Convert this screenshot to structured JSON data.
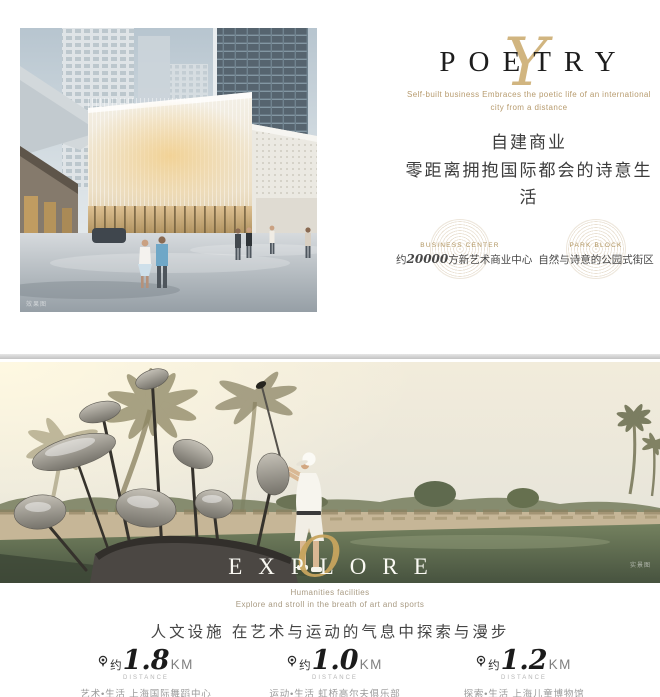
{
  "colors": {
    "gold_accent": "#c9a96b",
    "dark_text": "#1d1d1d",
    "chinese_text": "#3c3c3c",
    "grey_text": "#9b9b9b"
  },
  "poetry": {
    "script": "Y",
    "title": "POETRY",
    "sub1": "Self-built business Embraces the poetic life of an international",
    "sub2": "city from a distance",
    "zh1": "自建商业",
    "zh2": "零距离拥抱国际都会的诗意生活",
    "badges": [
      {
        "en": "BUSINESS CENTER",
        "zh_pre": "约",
        "zh_num": "20000",
        "zh_post": "方新艺术商业中心"
      },
      {
        "en": "PARK BLOCK",
        "zh": "自然与诗意的公园式街区"
      }
    ],
    "watermark": "效果图"
  },
  "explore": {
    "script": "O",
    "title": "EXPLORE",
    "sub1": "Humanities facilities",
    "sub2": "Explore and stroll in the breath of art and sports",
    "heading": "人文设施 在艺术与运动的气息中探索与漫步",
    "watermark": "实景图",
    "distances": [
      {
        "prefix": "约",
        "value": "1.8",
        "unit": "KM",
        "label": "DISTANCE",
        "desc": "艺术•生活 上海国际舞蹈中心"
      },
      {
        "prefix": "约",
        "value": "1.0",
        "unit": "KM",
        "label": "DISTANCE",
        "desc": "运动•生活 虹桥高尔夫俱乐部"
      },
      {
        "prefix": "约",
        "value": "1.2",
        "unit": "KM",
        "label": "DISTANCE",
        "desc": "探索•生活 上海儿童博物馆"
      }
    ]
  }
}
